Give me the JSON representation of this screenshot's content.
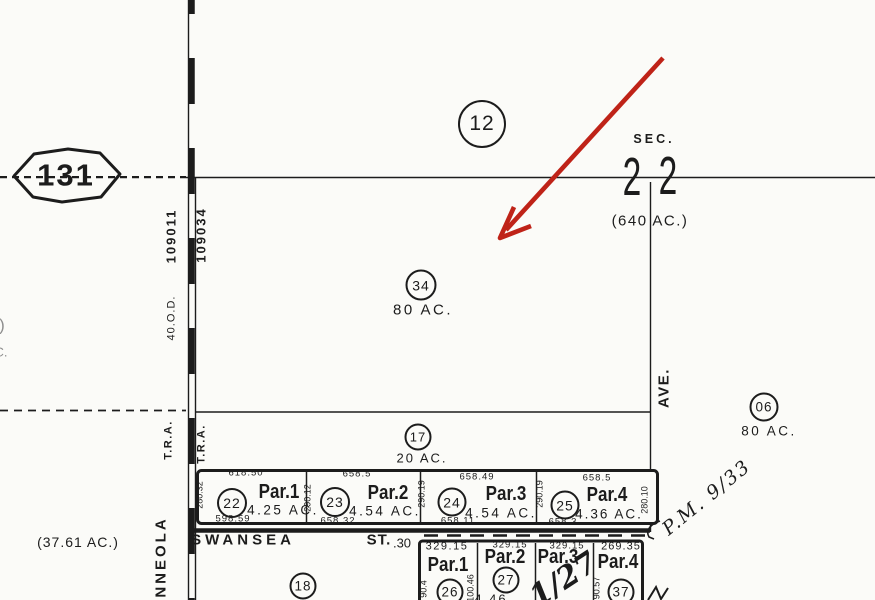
{
  "colors": {
    "ink": "#1c1c1c",
    "paper": "#fbfbf8",
    "arrow": "#bf2318"
  },
  "badge": {
    "route": "131"
  },
  "section": {
    "label": "SEC.",
    "digit_left": "2",
    "digit_right": "2",
    "acreage": "(640 AC.)",
    "circle": "12"
  },
  "areas": {
    "p34": {
      "circle": "34",
      "acreage": "80 AC."
    },
    "p17": {
      "circle": "17",
      "acreage": "20 AC."
    },
    "p06": {
      "circle": "06",
      "acreage": "80 AC."
    },
    "p18": {
      "circle": "18"
    },
    "left_acreage": "(37.61 AC.)"
  },
  "row1": {
    "parcels": [
      {
        "name": "Par.1",
        "circle": "22",
        "acreage": "4.25 AC.",
        "top": "618.50",
        "bottom": "598.59",
        "side": "280.32"
      },
      {
        "name": "Par.2",
        "circle": "23",
        "acreage": "4.54 AC.",
        "top": "658.5",
        "bottom": "658.32",
        "side": "290.12"
      },
      {
        "name": "Par.3",
        "circle": "24",
        "acreage": "4.54 AC.",
        "top": "658.49",
        "bottom": "658.11",
        "side": "290.19"
      },
      {
        "name": "Par.4",
        "circle": "25",
        "acreage": "4.36 AC.",
        "top": "658.5",
        "bottom": "658.3",
        "side": "290.25"
      }
    ],
    "right_side": "280.10"
  },
  "row2": {
    "parcels": [
      {
        "name": "Par.1",
        "circle": "26",
        "top": "329.15",
        "side": "90.4"
      },
      {
        "name": "Par.2",
        "circle": "27",
        "top": "329.15",
        "side": "100.46",
        "acreage": "4.46"
      },
      {
        "name": "Par.3",
        "top": "329.15"
      },
      {
        "name": "Par.4",
        "circle": "37",
        "top": "269.35",
        "side": "90.57"
      }
    ]
  },
  "street": {
    "name": "SWANSEA",
    "suffix": "ST.",
    "width": ".30"
  },
  "road": {
    "tract_left": "109011",
    "tract_right": "109034",
    "od": "40.O.D.",
    "tra_left": "T.R.A.",
    "tra_right": "T.R.A.",
    "minneola": "NNEOLA",
    "ave": "AVE."
  },
  "annotations": {
    "pm_ref": "P.M. 9/33",
    "handwritten": "1/27"
  },
  "fragments": {
    "paren": ")",
    "c": "C."
  }
}
